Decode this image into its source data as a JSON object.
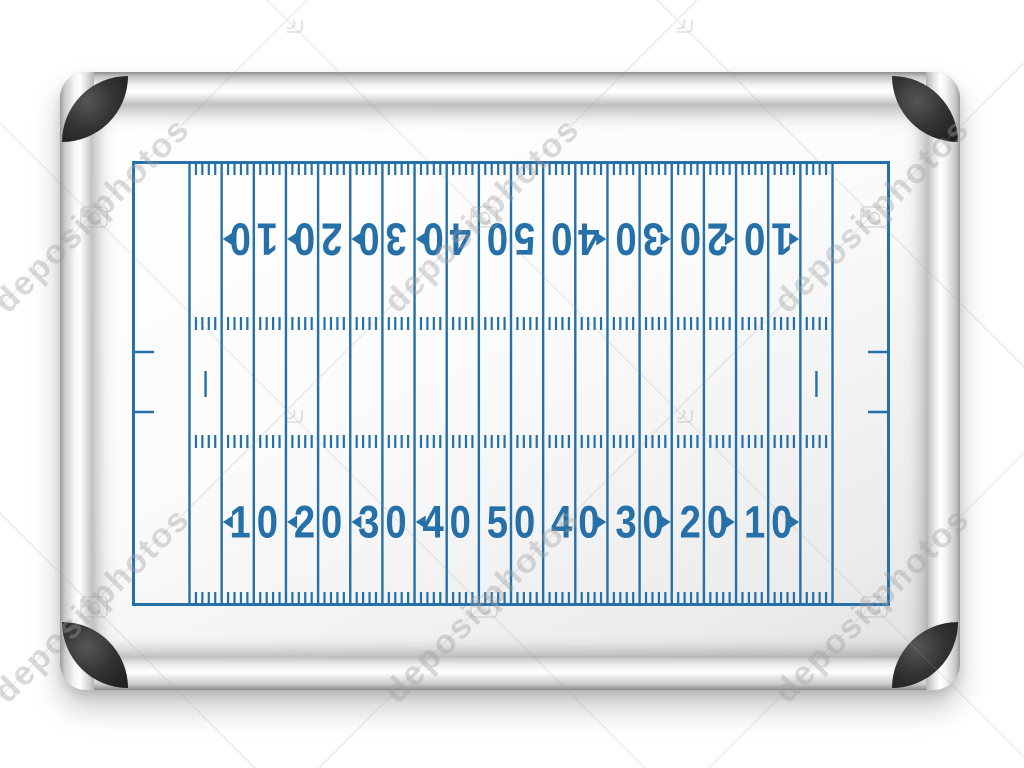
{
  "watermark": {
    "text": "depositphotos",
    "text_color": "#a8a8a8",
    "line_color": "#9a9a9a",
    "icon": "camera-icon"
  },
  "board": {
    "type": "whiteboard",
    "frame_color": "#d9d9d9",
    "corner_cap_color": "#2e2e2e",
    "surface_color": "#f8f8f8"
  },
  "field": {
    "sport": "american-football",
    "marker_color": "#2570a9",
    "yards": 100,
    "yard_line_interval": 5,
    "numbers_bottom": [
      {
        "label": "10",
        "arrow": "left"
      },
      {
        "label": "20",
        "arrow": "left"
      },
      {
        "label": "30",
        "arrow": "left"
      },
      {
        "label": "40",
        "arrow": "left"
      },
      {
        "label": "50",
        "arrow": "none"
      },
      {
        "label": "40",
        "arrow": "right"
      },
      {
        "label": "30",
        "arrow": "right"
      },
      {
        "label": "20",
        "arrow": "right"
      },
      {
        "label": "10",
        "arrow": "right"
      }
    ],
    "numbers_top": [
      {
        "label": "10",
        "arrow": "left"
      },
      {
        "label": "20",
        "arrow": "left"
      },
      {
        "label": "30",
        "arrow": "left"
      },
      {
        "label": "40",
        "arrow": "left"
      },
      {
        "label": "50",
        "arrow": "none"
      },
      {
        "label": "40",
        "arrow": "right"
      },
      {
        "label": "30",
        "arrow": "right"
      },
      {
        "label": "20",
        "arrow": "right"
      },
      {
        "label": "10",
        "arrow": "right"
      }
    ],
    "numbers_top_orientation": "upside-down"
  }
}
